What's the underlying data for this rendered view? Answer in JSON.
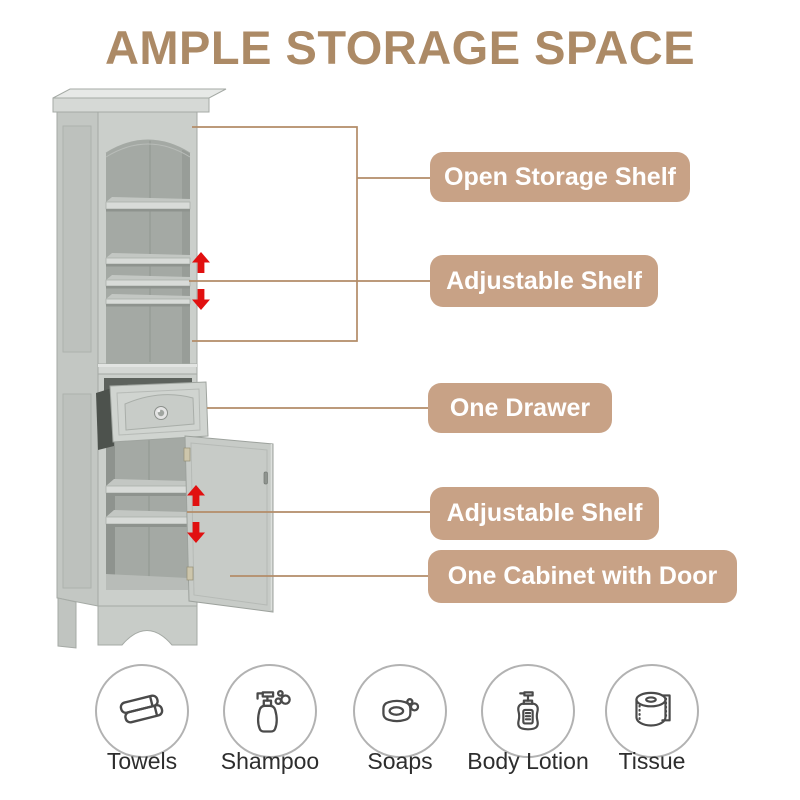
{
  "title": "AMPLE STORAGE SPACE",
  "callouts": [
    {
      "label": "Open Storage Shelf"
    },
    {
      "label": "Adjustable Shelf"
    },
    {
      "label": "One Drawer"
    },
    {
      "label": "Adjustable Shelf"
    },
    {
      "label": "One Cabinet with Door"
    }
  ],
  "essentials": [
    {
      "label": "Towels",
      "icon": "towels-icon"
    },
    {
      "label": "Shampoo",
      "icon": "shampoo-bottle-icon"
    },
    {
      "label": "Soaps",
      "icon": "soap-bar-icon"
    },
    {
      "label": "Body Lotion",
      "icon": "lotion-bottle-icon"
    },
    {
      "label": "Tissue",
      "icon": "tissue-roll-icon"
    }
  ],
  "colors": {
    "title_text": "#ac8a66",
    "badge_bg": "#c8a286",
    "badge_text": "#ffffff",
    "callout_line": "#b38c68",
    "arrow_red": "#e11010",
    "cabinet_body": "#cbcfcb",
    "cabinet_interior": "#a4a9a4",
    "icon_stroke": "#4a4a4a",
    "icon_circle_border": "#b2b2b2",
    "caption_text": "#2d2d2d"
  }
}
